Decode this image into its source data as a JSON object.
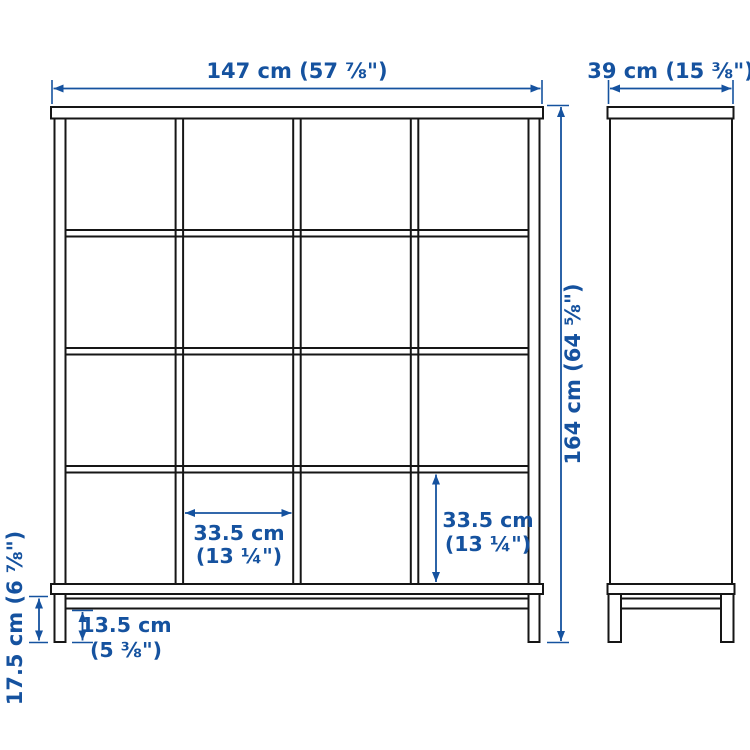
{
  "diagram": {
    "type": "product-dimension-diagram",
    "subject": "cube storage shelving unit with base, 4x4 grid, front and side views",
    "colors": {
      "dimension_blue": "#15529f",
      "outline_black": "#161616",
      "background": "#ffffff"
    },
    "front_view": {
      "grid_rows": "4",
      "grid_columns": "4",
      "width_label": "147 cm (57 ⅞\")",
      "height_label": "164 cm (64 ⅝\")",
      "cell_width_line1": "33.5 cm",
      "cell_width_line2": "(13 ¼\")",
      "cell_height_line1": "33.5 cm",
      "cell_height_line2": "(13 ¼\")",
      "plinth_height_label": "17.5 cm (6 ⅞\")",
      "leg_height_line1": "13.5 cm",
      "leg_height_line2": "(5 ⅜\")"
    },
    "side_view": {
      "depth_label": "39 cm (15 ⅜\")"
    }
  }
}
